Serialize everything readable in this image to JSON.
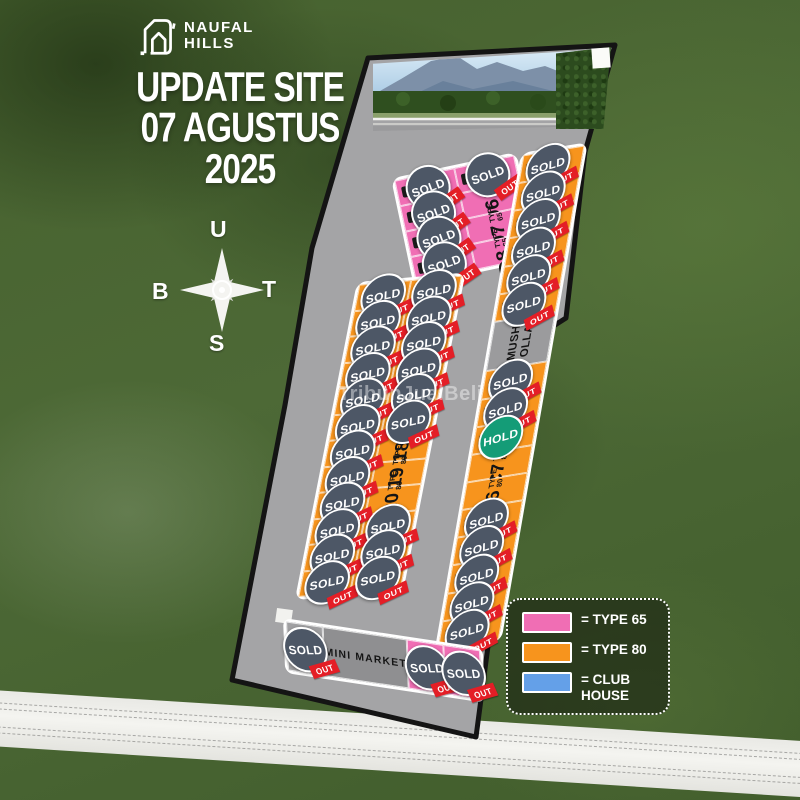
{
  "branding": {
    "name_line1": "NAUFAL",
    "name_line2": "HILLS"
  },
  "title": {
    "line1": "UPDATE SITE",
    "line2": "07 AGUSTUS",
    "line3": "2025"
  },
  "compass": {
    "north": "U",
    "east": "T",
    "south": "S",
    "west": "B"
  },
  "watermark": "TribunJualBeli",
  "badges": {
    "sold": "SOLD",
    "out": "OUT",
    "hold": "HOLD"
  },
  "facilities": {
    "musholla": "MUSH OLLA",
    "mini_market": "MINI MARKET"
  },
  "legend": {
    "items": [
      {
        "color": "#f06eb4",
        "label": "= TYPE 65"
      },
      {
        "color": "#f7941d",
        "label": "= TYPE 80"
      },
      {
        "color": "#64a0e8",
        "label": "= CLUB HOUSE"
      }
    ]
  },
  "colors": {
    "type65": "#f06eb4",
    "type80": "#f7941d",
    "club_house": "#64a0e8",
    "sold_badge": "#4d5766",
    "hold_badge": "#149c77",
    "out_ribbon": "#e41e26",
    "road": "#a4a4a6",
    "plan_border": "#141414"
  },
  "plan": {
    "blocks": {
      "d": {
        "columns": [
          [
            "S",
            "S",
            "S",
            "S"
          ],
          [
            "S",
            {
              "code": "D6",
              "type": "TYPE 65"
            },
            {
              "code": "D7",
              "type": "TYPE 65"
            },
            {
              "code": "D8",
              "type": "TYPE 65"
            }
          ]
        ]
      },
      "b": {
        "columns": [
          [
            "S",
            "S",
            "S",
            "S",
            "S",
            "S",
            "S",
            "S",
            "S",
            "S",
            "S",
            "S"
          ],
          [
            "S",
            "S",
            "S",
            "S",
            "S",
            "S",
            {
              "code": "B18",
              "type": "TYPE 80"
            },
            {
              "code": "B19",
              "type": "TYPE 80"
            },
            {
              "code": "B20",
              "type": "TYPE 80"
            },
            "S",
            "S",
            "S"
          ]
        ]
      },
      "c": {
        "columns": [
          [
            "S",
            "S",
            "S",
            "S",
            "S",
            "S",
            "MUSH",
            "S",
            "S",
            "H",
            {
              "code": "C7",
              "type": "TYPE 80"
            },
            {
              "code": "C6",
              "type": "TYPE 80"
            },
            "S",
            "S",
            "S",
            "S",
            "S"
          ]
        ]
      }
    }
  }
}
